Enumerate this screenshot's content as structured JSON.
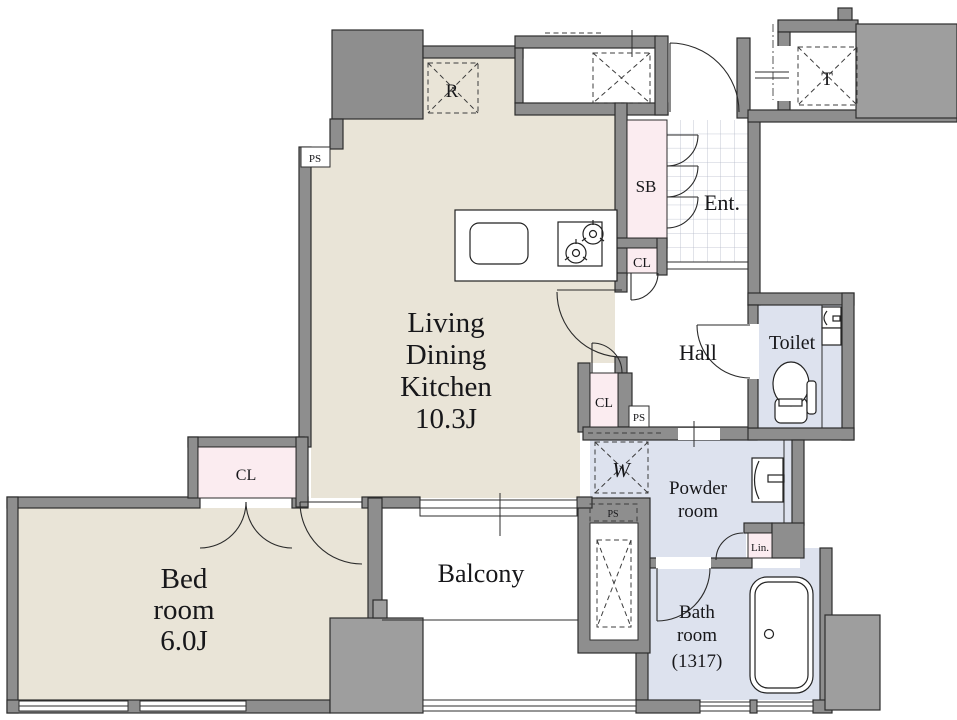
{
  "plan": {
    "rooms": {
      "living_dining_kitchen": {
        "name_lines": [
          "Living",
          "Dining",
          "Kitchen"
        ],
        "area": "10.3J"
      },
      "bedroom": {
        "name_lines": [
          "Bed",
          "room"
        ],
        "area": "6.0J"
      },
      "balcony": {
        "label": "Balcony"
      },
      "hall": {
        "label": "Hall"
      },
      "toilet": {
        "label": "Toilet"
      },
      "powder_room": {
        "name_lines": [
          "Powder",
          "room"
        ]
      },
      "bathroom": {
        "name_lines": [
          "Bath",
          "room"
        ],
        "size": "(1317)"
      },
      "entrance": {
        "label": "Ent."
      }
    },
    "labels": {
      "shoe_box": "SB",
      "closet": "CL",
      "linen": "Lin.",
      "pipe_space": "PS",
      "refrigerator": "R",
      "washer": "W",
      "trunk_room": "T"
    },
    "colors": {
      "flooring": "#e9e4d7",
      "wet_area": "#dde2ee",
      "storage_pink": "#fbecf0",
      "wall": "#8e8e8e",
      "common_area": "#9e9e9e",
      "outline": "#2d2d2d"
    }
  }
}
